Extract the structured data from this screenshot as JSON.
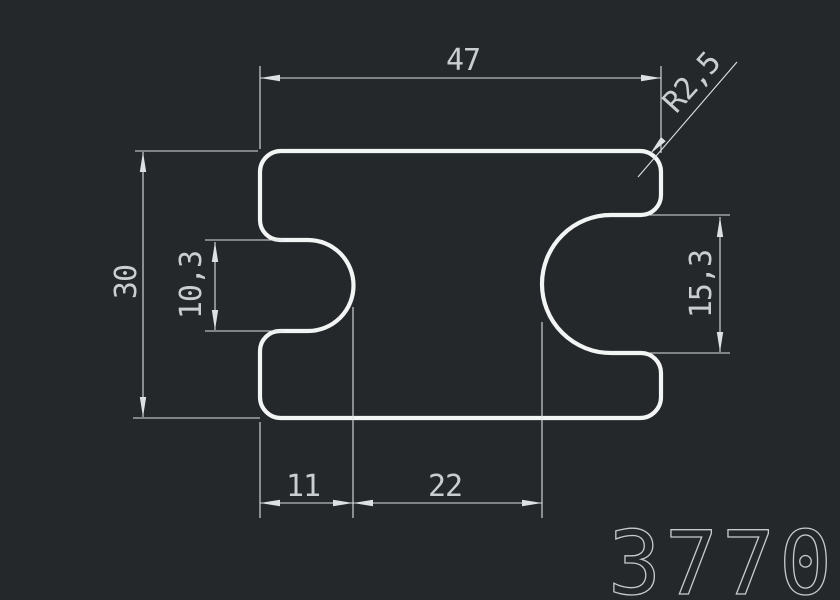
{
  "canvas": {
    "colors": {
      "background": "#24282b",
      "outline": "#f3f5f5",
      "dimension": "#dde1e3",
      "text": "#c9ced0",
      "part_number": "#c5cacc"
    }
  },
  "drawing": {
    "part_number": "3770",
    "dimensions": {
      "overall_width": "47",
      "overall_height": "30",
      "corner_radius": "R2,5",
      "left_notch_height": "10,3",
      "right_notch_height": "15,3",
      "left_notch_depth": "11",
      "notch_gap": "22"
    }
  }
}
